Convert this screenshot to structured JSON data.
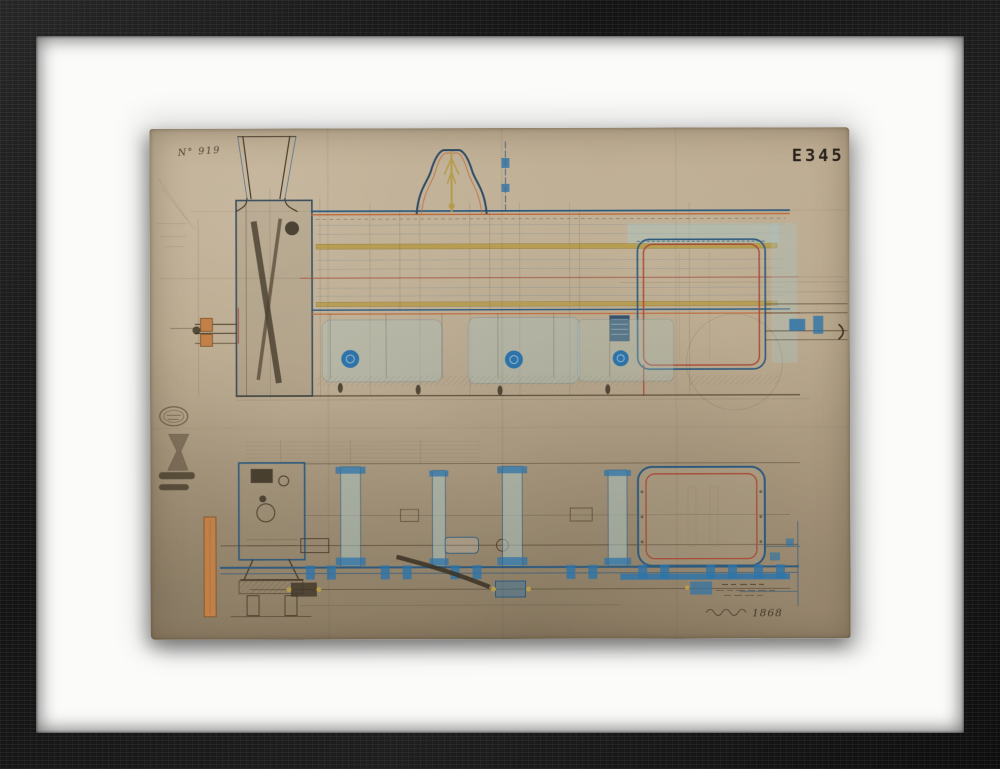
{
  "artwork": {
    "archive_number": "N° 919",
    "stamp_code": "E345",
    "inscription_year": "1868"
  },
  "palette": {
    "frame_wood": "#161616",
    "mat": "#fbfbfa",
    "paper": "#b6a58a",
    "ink_dark_blue": "#2e5a7d",
    "ink_bright_blue": "#2e73a8",
    "ink_red": "#a84b38",
    "ink_orange": "#bc6a3c",
    "ink_yellow": "#b59b4a",
    "ink_sepia": "#4a3c2b",
    "wash_blue": "#a9c3bf",
    "wood_plank": "#c08048"
  }
}
